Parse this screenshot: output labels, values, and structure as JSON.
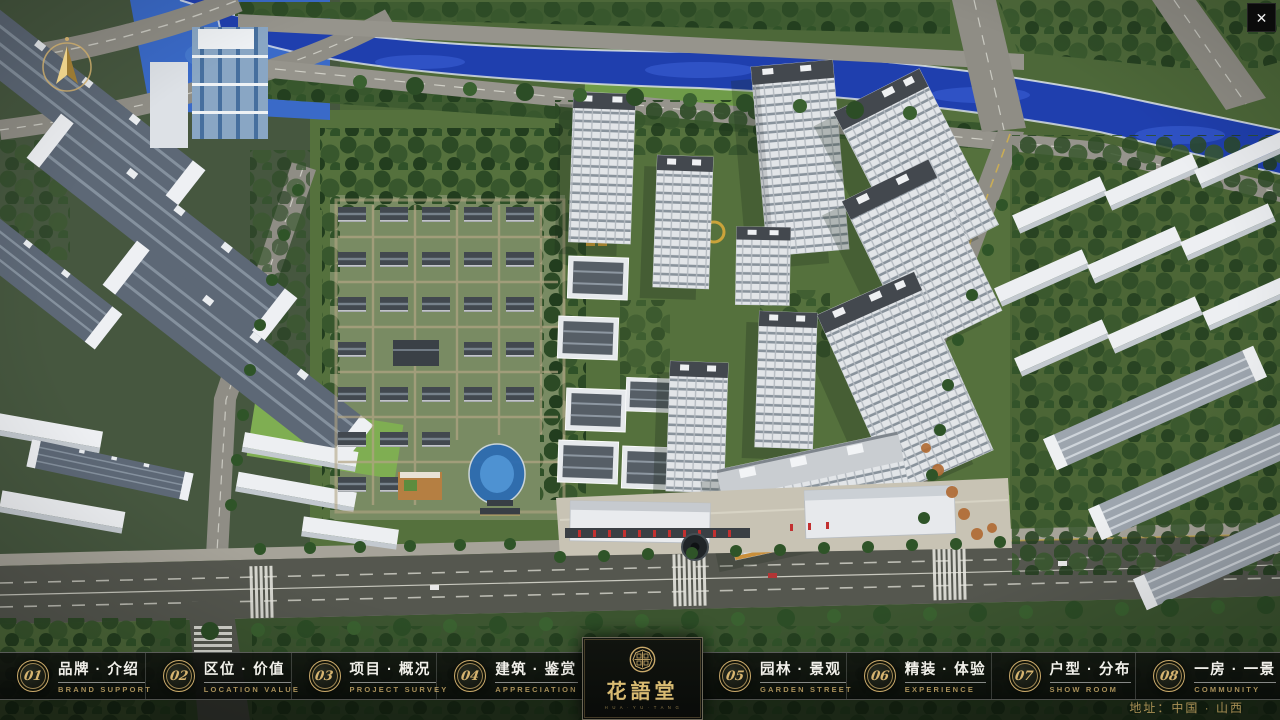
{
  "app": {
    "close_label": "✕"
  },
  "nav": {
    "items": [
      {
        "num": "01",
        "label": "品牌 · 介绍",
        "sub": "BRAND SUPPORT"
      },
      {
        "num": "02",
        "label": "区位 · 价值",
        "sub": "LOCATION VALUE"
      },
      {
        "num": "03",
        "label": "项目 · 概况",
        "sub": "PROJECT SURVEY"
      },
      {
        "num": "04",
        "label": "建筑 · 鉴赏",
        "sub": "APPRECIATION"
      },
      {
        "num": "05",
        "label": "园林 · 景观",
        "sub": "GARDEN STREET"
      },
      {
        "num": "06",
        "label": "精装 · 体验",
        "sub": "EXPERIENCE"
      },
      {
        "num": "07",
        "label": "户型 · 分布",
        "sub": "SHOW ROOM"
      },
      {
        "num": "08",
        "label": "一房 · 一景",
        "sub": "COMMUNITY"
      }
    ]
  },
  "logo": {
    "title": "花語堂",
    "caption": "H U A · Y U · T A N G"
  },
  "footer": {
    "address": "地址：中国 · 山西"
  },
  "colors": {
    "gold": "#c9a96a",
    "bar_bg": "#0c0e0b",
    "river": "#1f3fae",
    "tree": "#2c4d26"
  }
}
